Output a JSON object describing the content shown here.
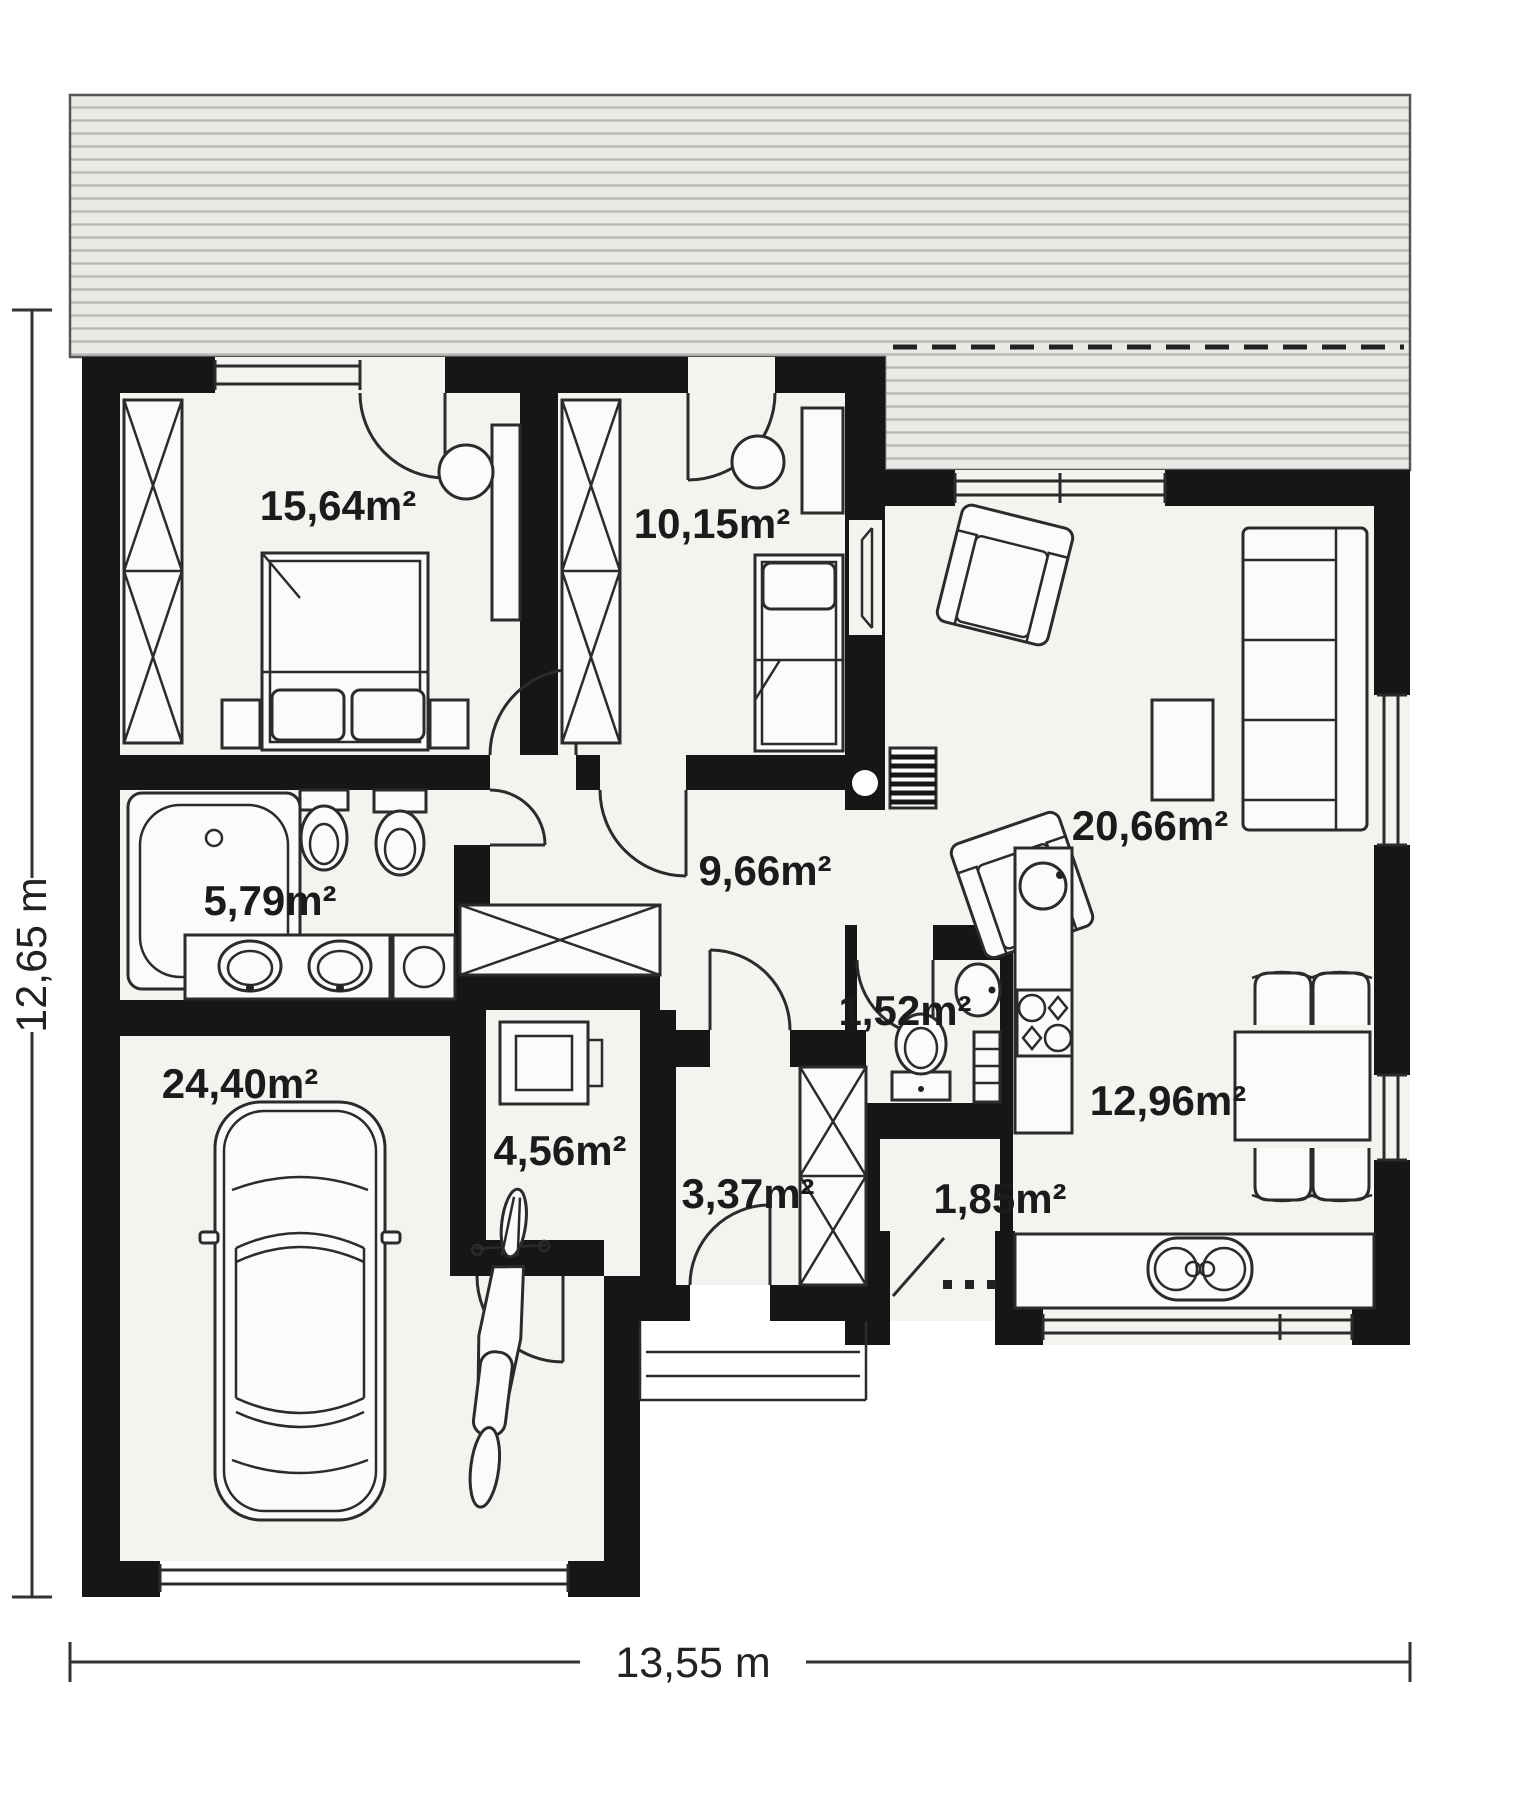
{
  "plan": {
    "type": "floor-plan",
    "dimensions": {
      "width": "13,55 m",
      "height": "12,65 m"
    },
    "rooms": [
      {
        "name": "bedroom-main",
        "area": "15,64m²",
        "furniture": [
          "wardrobe",
          "double-bed",
          "nightstands",
          "desk",
          "chair"
        ]
      },
      {
        "name": "bedroom-second",
        "area": "10,15m²",
        "furniture": [
          "wardrobe",
          "single-bed",
          "desk",
          "chair"
        ]
      },
      {
        "name": "living-room",
        "area": "20,66m²",
        "furniture": [
          "sofa",
          "two-armchairs",
          "coffee-table",
          "tv",
          "radiator"
        ]
      },
      {
        "name": "bathroom",
        "area": "5,79m²",
        "furniture": [
          "bathtub",
          "bidet",
          "toilet",
          "double-vanity",
          "washing-machine"
        ]
      },
      {
        "name": "hall",
        "area": "9,66m²",
        "furniture": [
          "closet"
        ]
      },
      {
        "name": "garage",
        "area": "24,40m²",
        "furniture": [
          "car",
          "motorcycle"
        ]
      },
      {
        "name": "utility-room",
        "area": "4,56m²",
        "furniture": [
          "boiler"
        ]
      },
      {
        "name": "vestibule",
        "area": "3,37m²",
        "furniture": [
          "wardrobe"
        ]
      },
      {
        "name": "wc",
        "area": "1,52m²",
        "furniture": [
          "sink",
          "toilet",
          "shelf"
        ]
      },
      {
        "name": "pantry",
        "area": "1,85m²",
        "furniture": []
      },
      {
        "name": "kitchen-dining",
        "area": "12,96m²",
        "furniture": [
          "cooktop",
          "kitchen-sink",
          "counter",
          "double-sink",
          "dining-table",
          "four-chairs"
        ]
      }
    ],
    "colors": {
      "wall": "#161616",
      "room_fill": "#f3f3f0",
      "terrace_fill": "#e9e9e6",
      "hatch_line": "#b9b9b5",
      "line": "#2b2b2b"
    }
  }
}
